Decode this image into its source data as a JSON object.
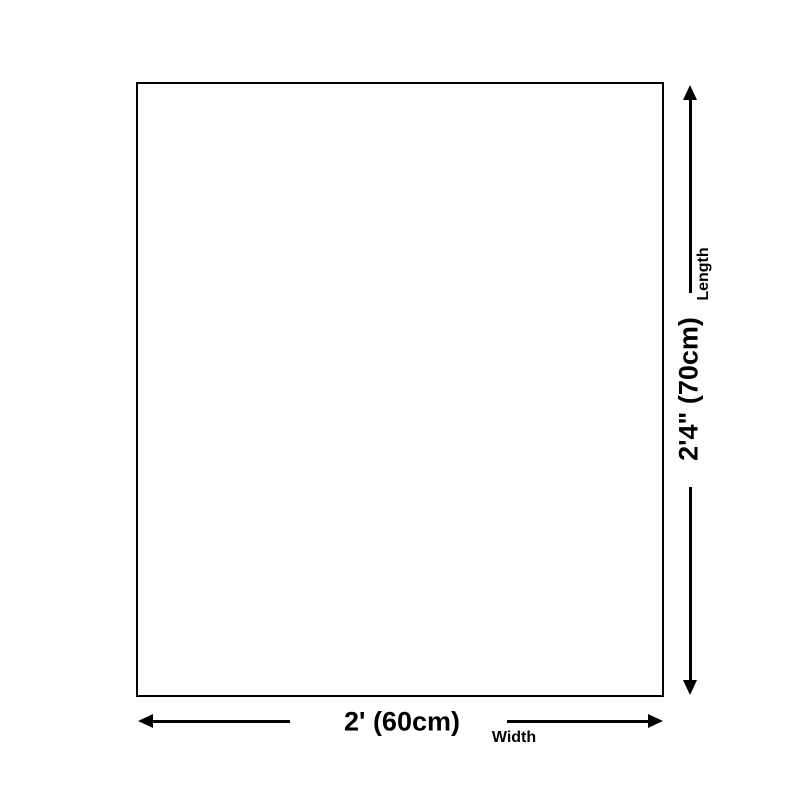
{
  "diagram": {
    "background_color": "#ffffff",
    "outline_color": "#000000",
    "arrow_color": "#000000",
    "text_color": "#000000",
    "product_outline": {
      "shape": "rectangle",
      "fill": "#ffffff"
    },
    "width": {
      "value": "2' (60cm)",
      "label": "Width"
    },
    "length": {
      "value": "2'4\" (70cm)",
      "label": "Length"
    }
  }
}
